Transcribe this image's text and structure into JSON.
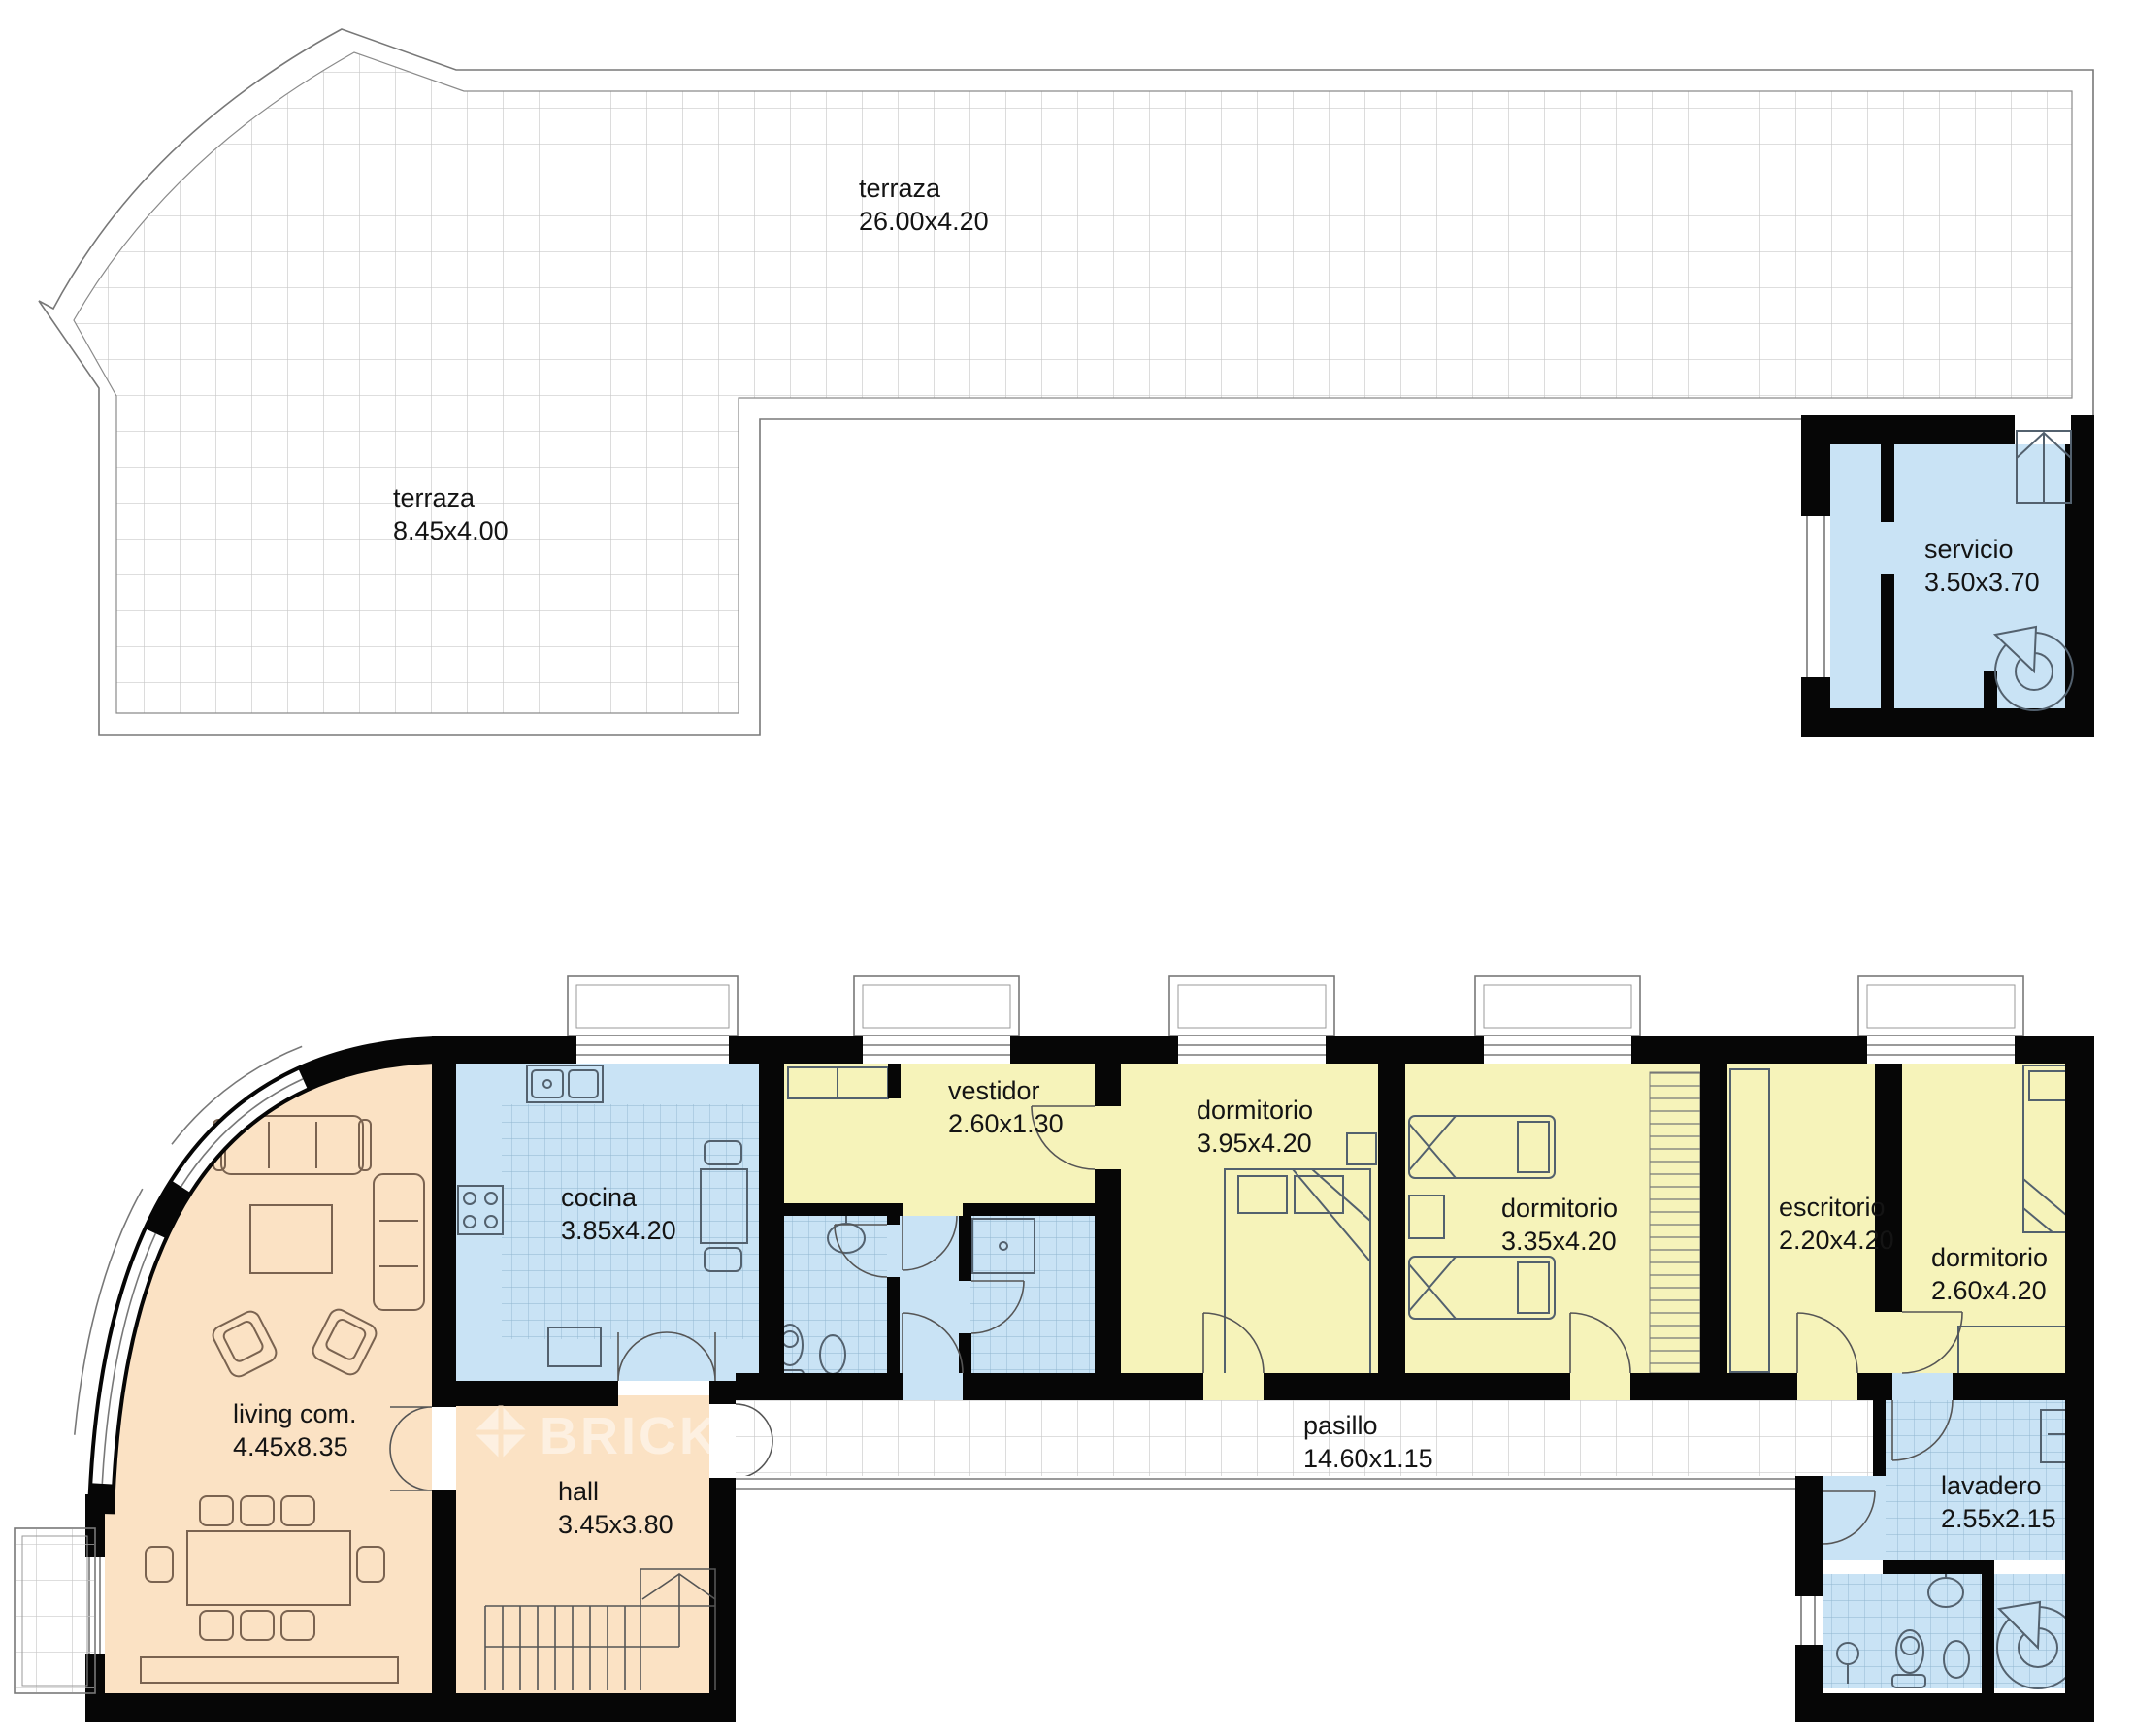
{
  "watermark": {
    "brand": "BRICK"
  },
  "colors": {
    "room_blue": "#c9e3f5",
    "room_yellow": "#f6f3ba",
    "room_peach": "#fbe2c4",
    "wall_black": "#060606",
    "grid_gray": "#c9c9c9",
    "tile_blue_line": "#8fb6cf"
  },
  "rooms": {
    "terraza_top": {
      "name": "terraza",
      "dims": "26.00x4.20"
    },
    "terraza_left": {
      "name": "terraza",
      "dims": "8.45x4.00"
    },
    "servicio": {
      "name": "servicio",
      "dims": "3.50x3.70"
    },
    "cocina": {
      "name": "cocina",
      "dims": "3.85x4.20"
    },
    "vestidor": {
      "name": "vestidor",
      "dims": "2.60x1.30"
    },
    "dormitorio_1": {
      "name": "dormitorio",
      "dims": "3.95x4.20"
    },
    "dormitorio_2": {
      "name": "dormitorio",
      "dims": "3.35x4.20"
    },
    "escritorio": {
      "name": "escritorio",
      "dims": "2.20x4.20"
    },
    "dormitorio_3": {
      "name": "dormitorio",
      "dims": "2.60x4.20"
    },
    "living": {
      "name": "living com.",
      "dims": "4.45x8.35"
    },
    "hall": {
      "name": "hall",
      "dims": "3.45x3.80"
    },
    "pasillo": {
      "name": "pasillo",
      "dims": "14.60x1.15"
    },
    "lavadero": {
      "name": "lavadero",
      "dims": "2.55x2.15"
    }
  }
}
